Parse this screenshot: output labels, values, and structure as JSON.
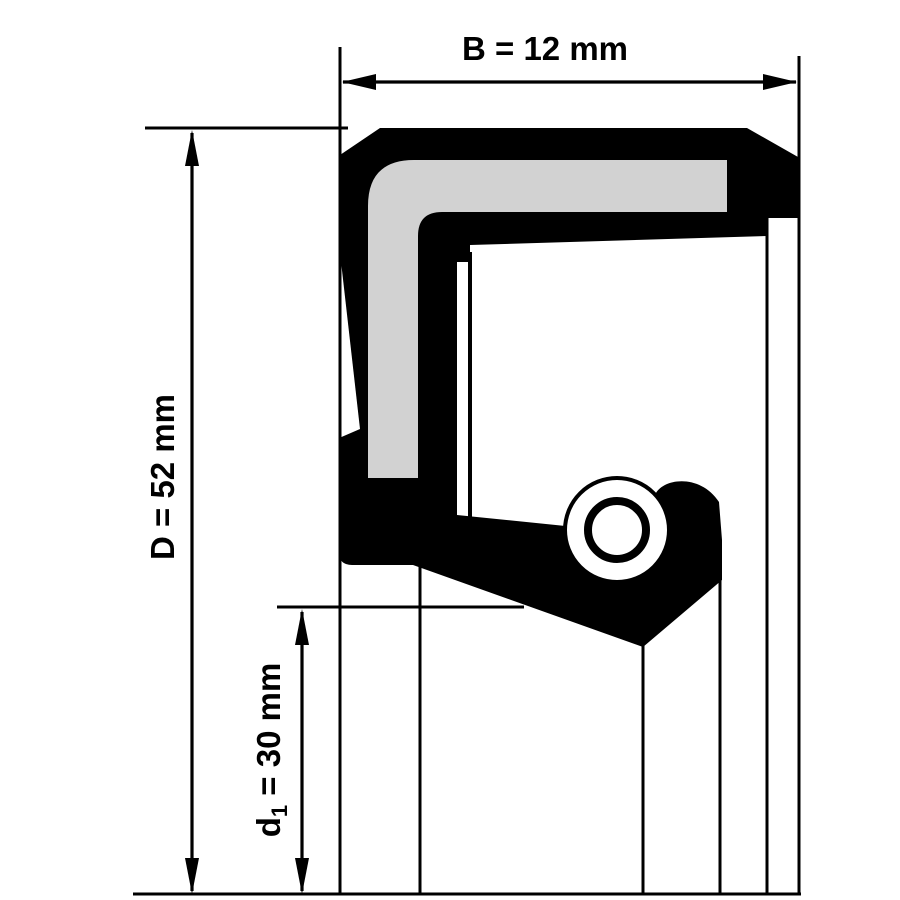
{
  "drawing": {
    "title": "Radial shaft seal cross-section with dimensions",
    "colors": {
      "ink": "#000000",
      "insert": "#d2d2d2",
      "background": "#ffffff"
    },
    "dimensions": {
      "B": {
        "label": "B = 12 mm"
      },
      "D": {
        "label": "D = 52 mm"
      },
      "d1": {
        "base": "d",
        "sub": "1",
        "rest": " = 30 mm",
        "full": "d1 = 30 mm"
      }
    }
  }
}
